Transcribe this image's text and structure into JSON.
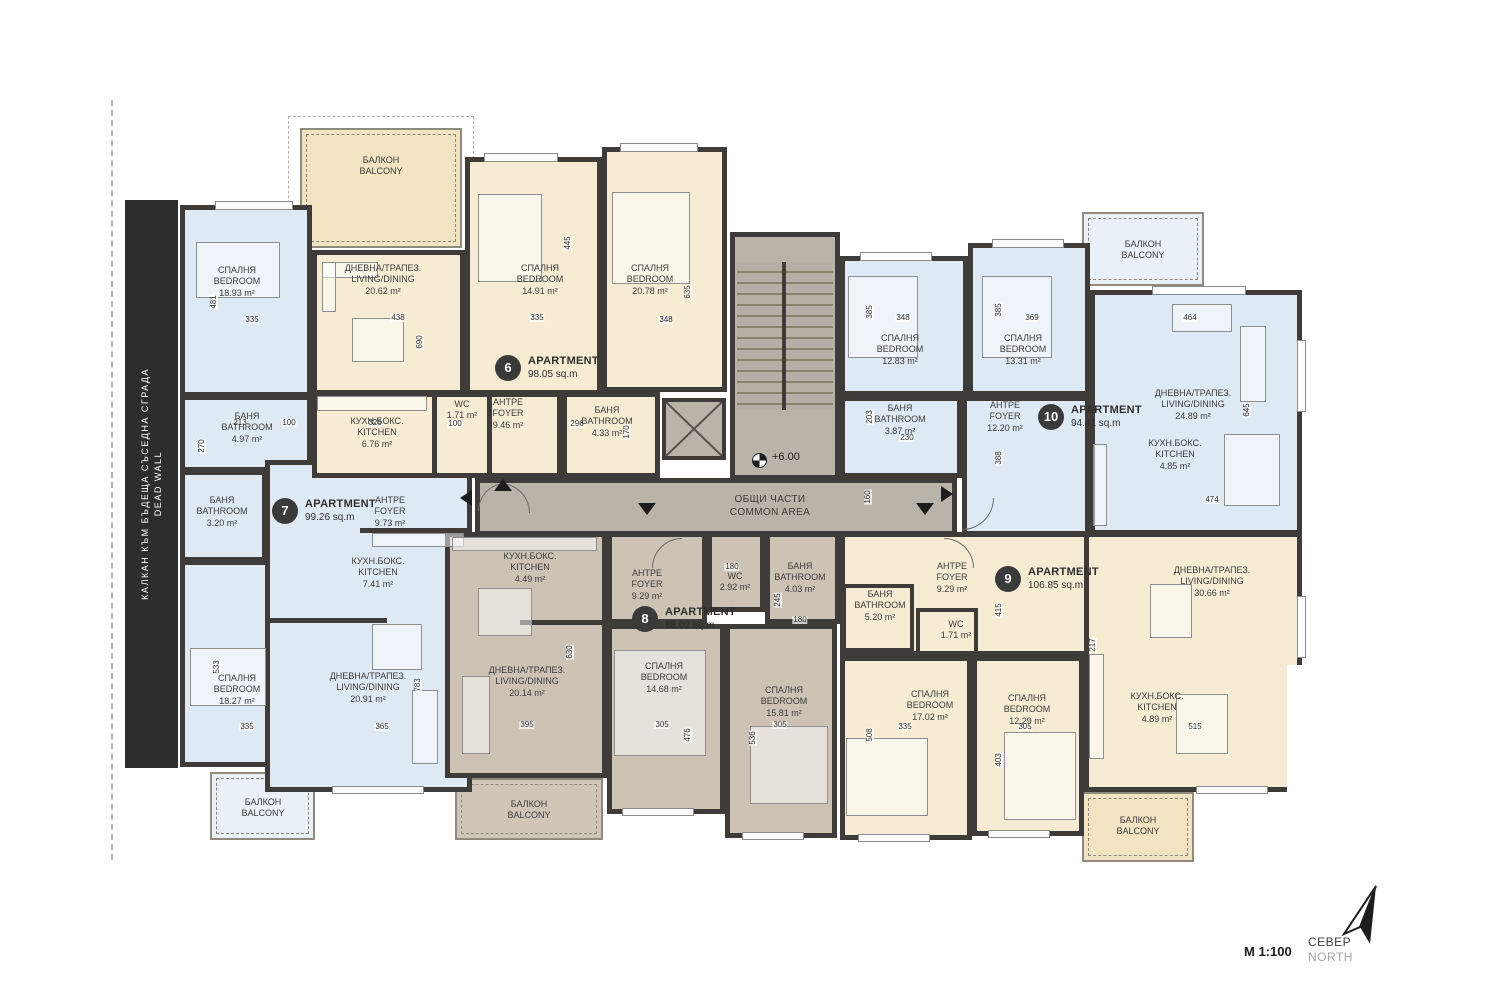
{
  "plan": {
    "level_marker": "+6.00",
    "scale_label": "М 1:100",
    "north_bg": "СЕВЕР",
    "north_en": "NORTH",
    "dead_wall_bg": "КАЛКАН КЪМ БЪДЕЩА СЪСЕДНА СГРАДА",
    "dead_wall_en": "DEAD WALL",
    "common_bg": "ОБЩИ ЧАСТИ",
    "common_en": "COMMON AREA",
    "balcony_bg": "БАЛКОН",
    "balcony_en": "BALCONY"
  },
  "apartments": [
    {
      "number": "6",
      "label": "APARTMENT",
      "area": "98.05 sq.m"
    },
    {
      "number": "7",
      "label": "APARTMENT",
      "area": "99.26 sq.m"
    },
    {
      "number": "8",
      "label": "APARTMENT",
      "area": "88.02 sq.m"
    },
    {
      "number": "9",
      "label": "APARTMENT",
      "area": "106.85 sq.m"
    },
    {
      "number": "10",
      "label": "APARTMENT",
      "area": "94.41 sq.m"
    }
  ],
  "rooms": [
    {
      "bg": "ДНЕВНА/ТРАПЕЗ.",
      "en": "LIVING/DINING",
      "area": "20.62 m²"
    },
    {
      "bg": "СПАЛНЯ",
      "en": "BEDROOM",
      "area": "14.91 m²"
    },
    {
      "bg": "СПАЛНЯ",
      "en": "BEDROOM",
      "area": "20.78 m²"
    },
    {
      "bg": "КУХН.БОКС.",
      "en": "KITCHEN",
      "area": "6.76 m²"
    },
    {
      "bg": "WC",
      "en": "",
      "area": "1.71 m²"
    },
    {
      "bg": "АНТРЕ",
      "en": "FOYER",
      "area": "9.46 m²"
    },
    {
      "bg": "БАНЯ",
      "en": "BATHROOM",
      "area": "4.33 m²"
    },
    {
      "bg": "СПАЛНЯ",
      "en": "BEDROOM",
      "area": "18.93 m²"
    },
    {
      "bg": "БАНЯ",
      "en": "BATHROOM",
      "area": "4.97 m²"
    },
    {
      "bg": "БАНЯ",
      "en": "BATHROOM",
      "area": "3.20 m²"
    },
    {
      "bg": "АНТРЕ",
      "en": "FOYER",
      "area": "9.73 m²"
    },
    {
      "bg": "КУХН.БОКС.",
      "en": "KITCHEN",
      "area": "7.41 m²"
    },
    {
      "bg": "СПАЛНЯ",
      "en": "BEDROOM",
      "area": "18.27 m²"
    },
    {
      "bg": "ДНЕВНА/ТРАПЕЗ.",
      "en": "LIVING/DINING",
      "area": "20.91 m²"
    },
    {
      "bg": "КУХН.БОКС.",
      "en": "KITCHEN",
      "area": "4.49 m²"
    },
    {
      "bg": "АНТРЕ",
      "en": "FOYER",
      "area": "9.29 m²"
    },
    {
      "bg": "WC",
      "en": "",
      "area": "2.92 m²"
    },
    {
      "bg": "БАНЯ",
      "en": "BATHROOM",
      "area": "4.03 m²"
    },
    {
      "bg": "ДНЕВНА/ТРАПЕЗ.",
      "en": "LIVING/DINING",
      "area": "20.14 m²"
    },
    {
      "bg": "СПАЛНЯ",
      "en": "BEDROOM",
      "area": "14.68 m²"
    },
    {
      "bg": "СПАЛНЯ",
      "en": "BEDROOM",
      "area": "15.81 m²"
    },
    {
      "bg": "АНТРЕ",
      "en": "FOYER",
      "area": "9.29 m²"
    },
    {
      "bg": "БАНЯ",
      "en": "BATHROOM",
      "area": "5.20 m²"
    },
    {
      "bg": "WC",
      "en": "",
      "area": "1.71 m²"
    },
    {
      "bg": "СПАЛНЯ",
      "en": "BEDROOM",
      "area": "17.02 m²"
    },
    {
      "bg": "СПАЛНЯ",
      "en": "BEDROOM",
      "area": "12.29 m²"
    },
    {
      "bg": "КУХН.БОКС.",
      "en": "KITCHEN",
      "area": "4.89 m²"
    },
    {
      "bg": "ДНЕВНА/ТРАПЕЗ.",
      "en": "LIVING/DINING",
      "area": "30.66 m²"
    },
    {
      "bg": "СПАЛНЯ",
      "en": "BEDROOM",
      "area": "12.83 m²"
    },
    {
      "bg": "СПАЛНЯ",
      "en": "BEDROOM",
      "area": "13.31 m²"
    },
    {
      "bg": "БАНЯ",
      "en": "BATHROOM",
      "area": "3.87 m²"
    },
    {
      "bg": "АНТРЕ",
      "en": "FOYER",
      "area": "12.20 m²"
    },
    {
      "bg": "ДНЕВНА/ТРАПЕЗ.",
      "en": "LIVING/DINING",
      "area": "24.89 m²"
    },
    {
      "bg": "КУХН.БОКС.",
      "en": "KITCHEN",
      "area": "4.85 m²"
    }
  ],
  "dims": [
    "481",
    "335",
    "438",
    "690",
    "213",
    "100",
    "326",
    "270",
    "445",
    "335",
    "348",
    "635",
    "296",
    "170",
    "100",
    "385",
    "348",
    "369",
    "385",
    "203",
    "230",
    "388",
    "464",
    "645",
    "474",
    "533",
    "335",
    "365",
    "783",
    "630",
    "395",
    "305",
    "476",
    "536",
    "305",
    "508",
    "335",
    "305",
    "403",
    "415",
    "217",
    "515",
    "180",
    "245",
    "180",
    "160"
  ]
}
